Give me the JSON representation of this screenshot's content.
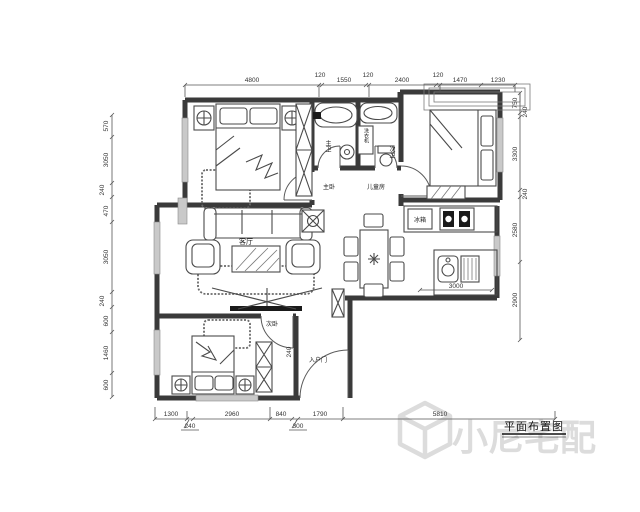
{
  "drawing": {
    "title": "平面布置图",
    "watermark_text": "小尼宅配",
    "rooms": {
      "living_room": "客厅",
      "master_bedroom": "主卧",
      "second_bedroom": "次卧",
      "kids_room": "儿童房",
      "master_bath": "主卫",
      "second_bath": "次卫",
      "entry_door": "入户门",
      "washing_machine": "洗衣机",
      "fridge": "冰箱"
    },
    "dimensions": {
      "top": [
        "4800",
        "120",
        "1550",
        "120",
        "2400",
        "120",
        "1470",
        "1230"
      ],
      "left": [
        "570",
        "3050",
        "240",
        "470",
        "3050",
        "240",
        "600",
        "1460",
        "600"
      ],
      "right": [
        "750",
        "240",
        "3300",
        "240",
        "2580",
        "2900"
      ],
      "bottom": [
        "1300",
        "240",
        "2960",
        "840",
        "300",
        "1790",
        "5810"
      ],
      "kitchen": "3000",
      "entry_wall": "240"
    },
    "colors": {
      "wall": "#3a3a3a",
      "dimension": "#555555",
      "window": "#c9c9c9",
      "watermark": "#d6d6d6"
    }
  }
}
